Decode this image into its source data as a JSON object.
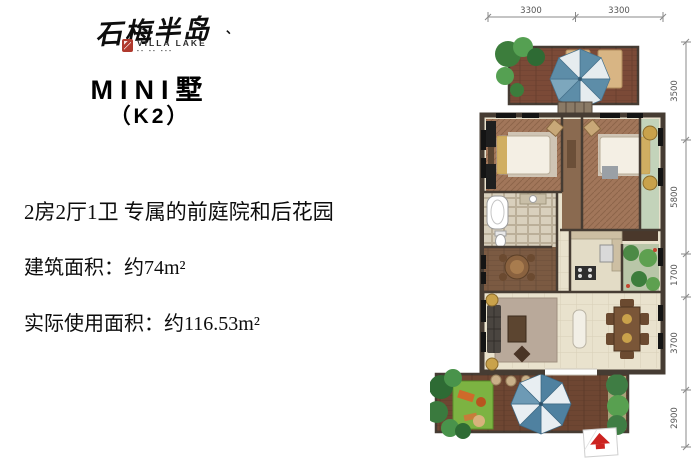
{
  "logo": {
    "calligraphy": "石梅半岛",
    "accent_mark": "、",
    "sub_brand": "VILLA LAKE",
    "tagline_glyphs": "▪▪ ▪▪ ▪▪▪",
    "seal_color": "#b03a2e"
  },
  "product": {
    "series_title": "MINI墅",
    "unit_code": "（K2）"
  },
  "details": {
    "headline": "2房2厅1卫 专属的前庭院和后花园",
    "built_area": "建筑面积：约74m²",
    "usable_area": "实际使用面积：约116.53m²"
  },
  "floorplan": {
    "dim_top": [
      "3300",
      "3300"
    ],
    "dim_right": [
      "3500",
      "5800",
      "1700",
      "3700",
      "2900"
    ],
    "colors": {
      "deck": "#74452f",
      "wood_floor": "#a1765a",
      "tile": "#e9e2cd",
      "wall": "#463c33",
      "lawn": "#7cb342",
      "tree_dark": "#2e6b34",
      "tree_light": "#55a052",
      "umbrella_blue": "#5d8da8",
      "bay_green": "#c3d3ba",
      "dimension_text": "#555555",
      "north_red": "#cc2320"
    }
  }
}
